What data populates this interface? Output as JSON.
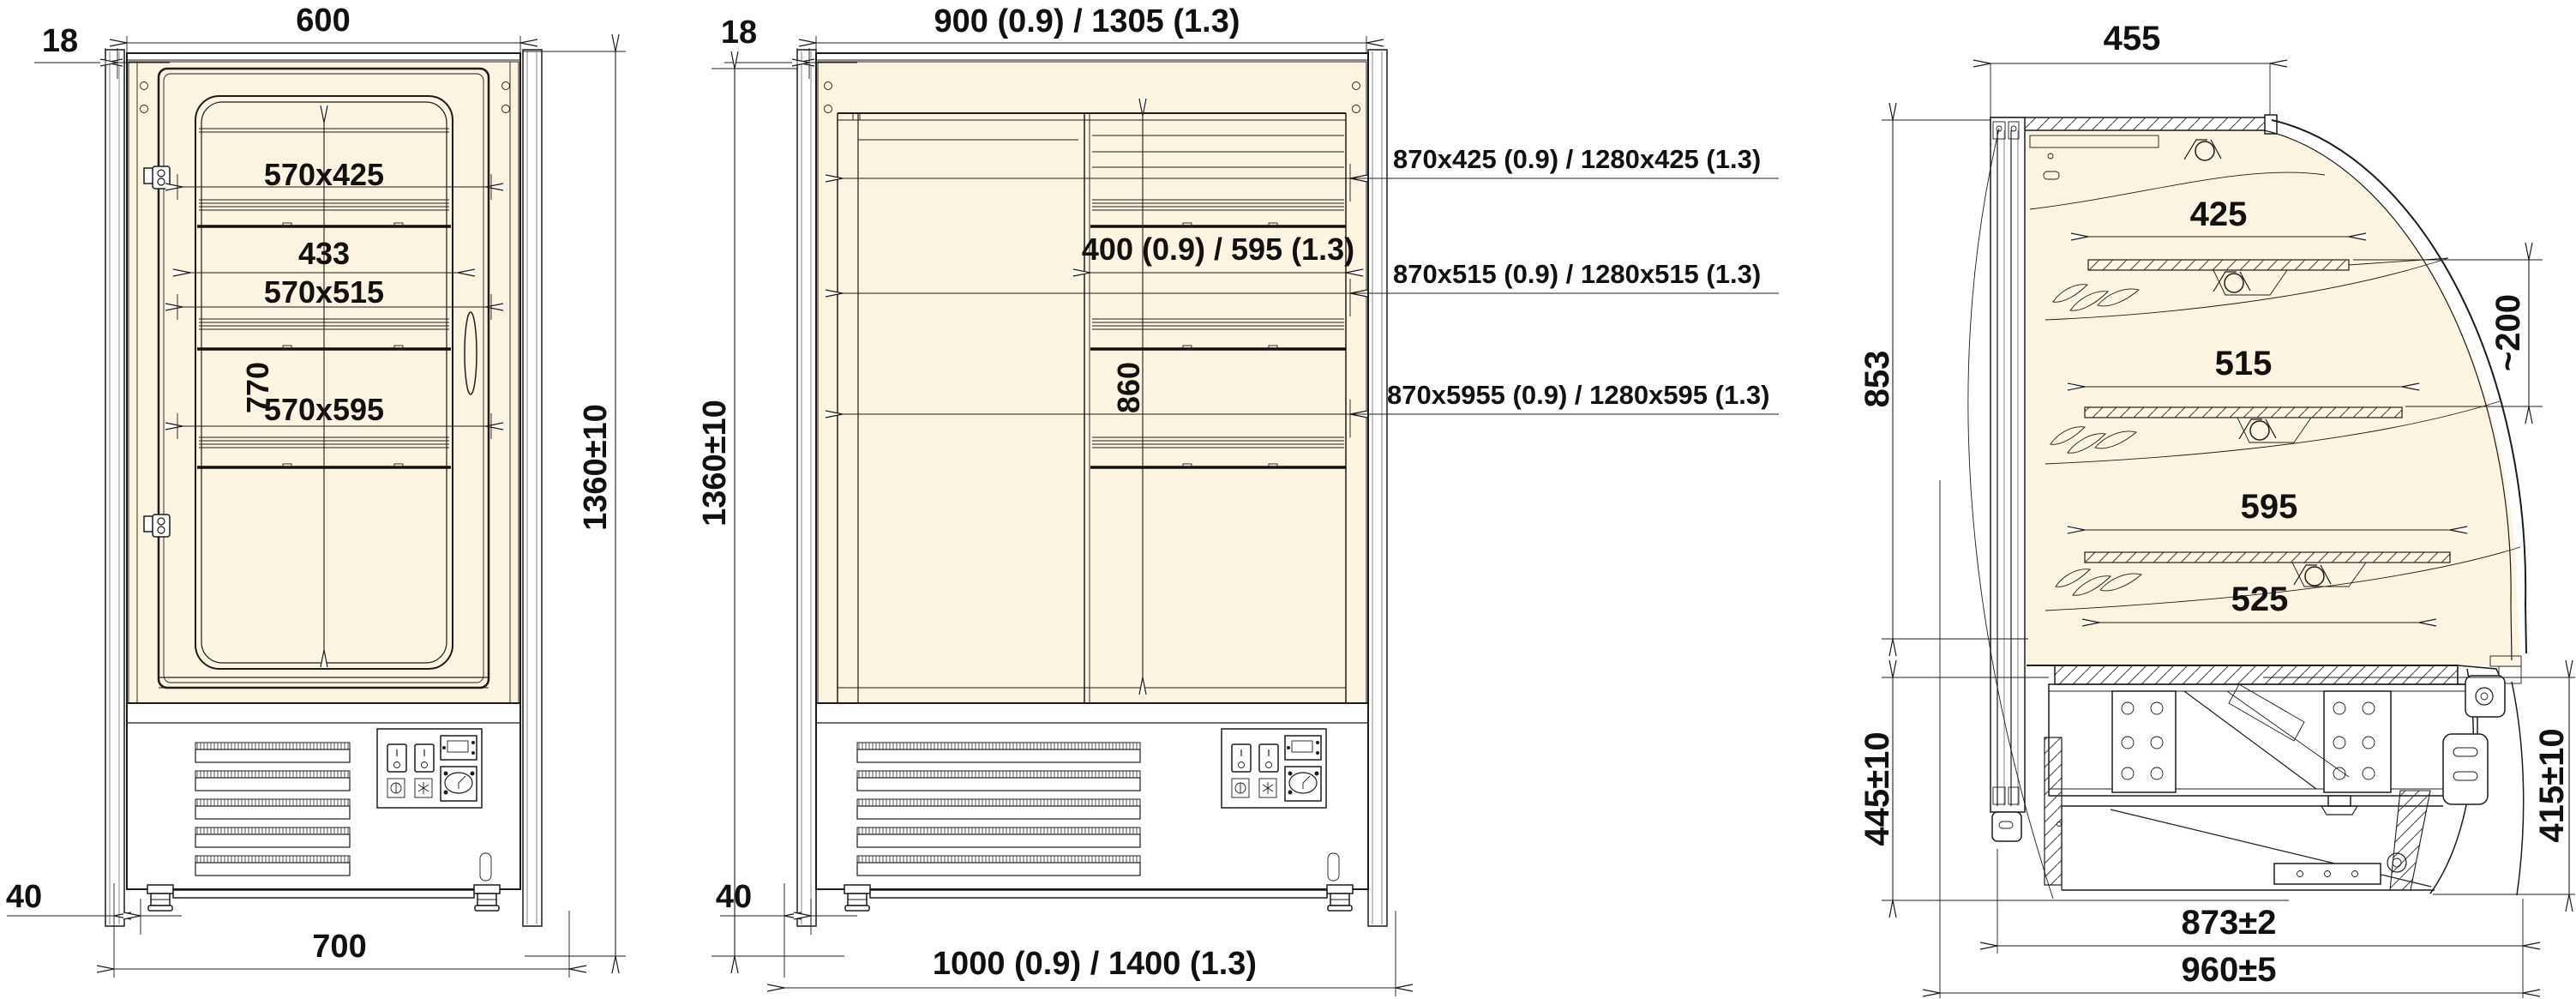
{
  "drawing": {
    "background": "#ffffff",
    "line_color": "#1c1c1c",
    "interior_fill": "#FBF4E1",
    "icons": {
      "lamp": "lamp-icon",
      "power": "power-switch-icon",
      "light_switch": "light-switch-icon",
      "controller": "controller-display-icon",
      "thermostat": "thermostat-dial-icon",
      "leaves": "bakery-decor-icon"
    },
    "views": {
      "front_narrow": {
        "title": "front-view-0.7-model",
        "dim_side_panel": "18",
        "dim_width_top": "600",
        "dim_shelf_top": "570x425",
        "dim_inner_width": "433",
        "dim_shelf_mid": "570x515",
        "dim_inner_height": "770",
        "dim_shelf_bottom": "570x595",
        "dim_height": "1360±10",
        "dim_foot_offset": "40",
        "dim_width_bottom": "700"
      },
      "front_wide": {
        "title": "front-view-0.9-1.3-models",
        "dim_side_panel": "18",
        "dim_width_top": "900 (0.9) / 1305 (1.3)",
        "dim_height": "1360±10",
        "dim_shelf_width": "400 (0.9) / 595 (1.3)",
        "dim_inner_height": "860",
        "dim_foot_offset": "40",
        "dim_width_bottom": "1000 (0.9) / 1400 (1.3)",
        "callout_shelf_top": "870x425 (0.9) / 1280x425 (1.3)",
        "callout_shelf_mid": "870x515 (0.9) / 1280x515 (1.3)",
        "callout_shelf_bottom": "870x5955 (0.9) / 1280x595 (1.3)"
      },
      "side": {
        "title": "side-section-view",
        "dim_depth_top": "455",
        "dim_shelf1": "425",
        "dim_shelf_gap": "~200",
        "dim_glass_height": "853",
        "dim_shelf2": "515",
        "dim_shelf3": "595",
        "dim_deck": "525",
        "dim_base_height_rear": "445±10",
        "dim_base_height_front": "415±10",
        "dim_base_depth": "873±2",
        "dim_total_depth": "960±5"
      }
    }
  }
}
